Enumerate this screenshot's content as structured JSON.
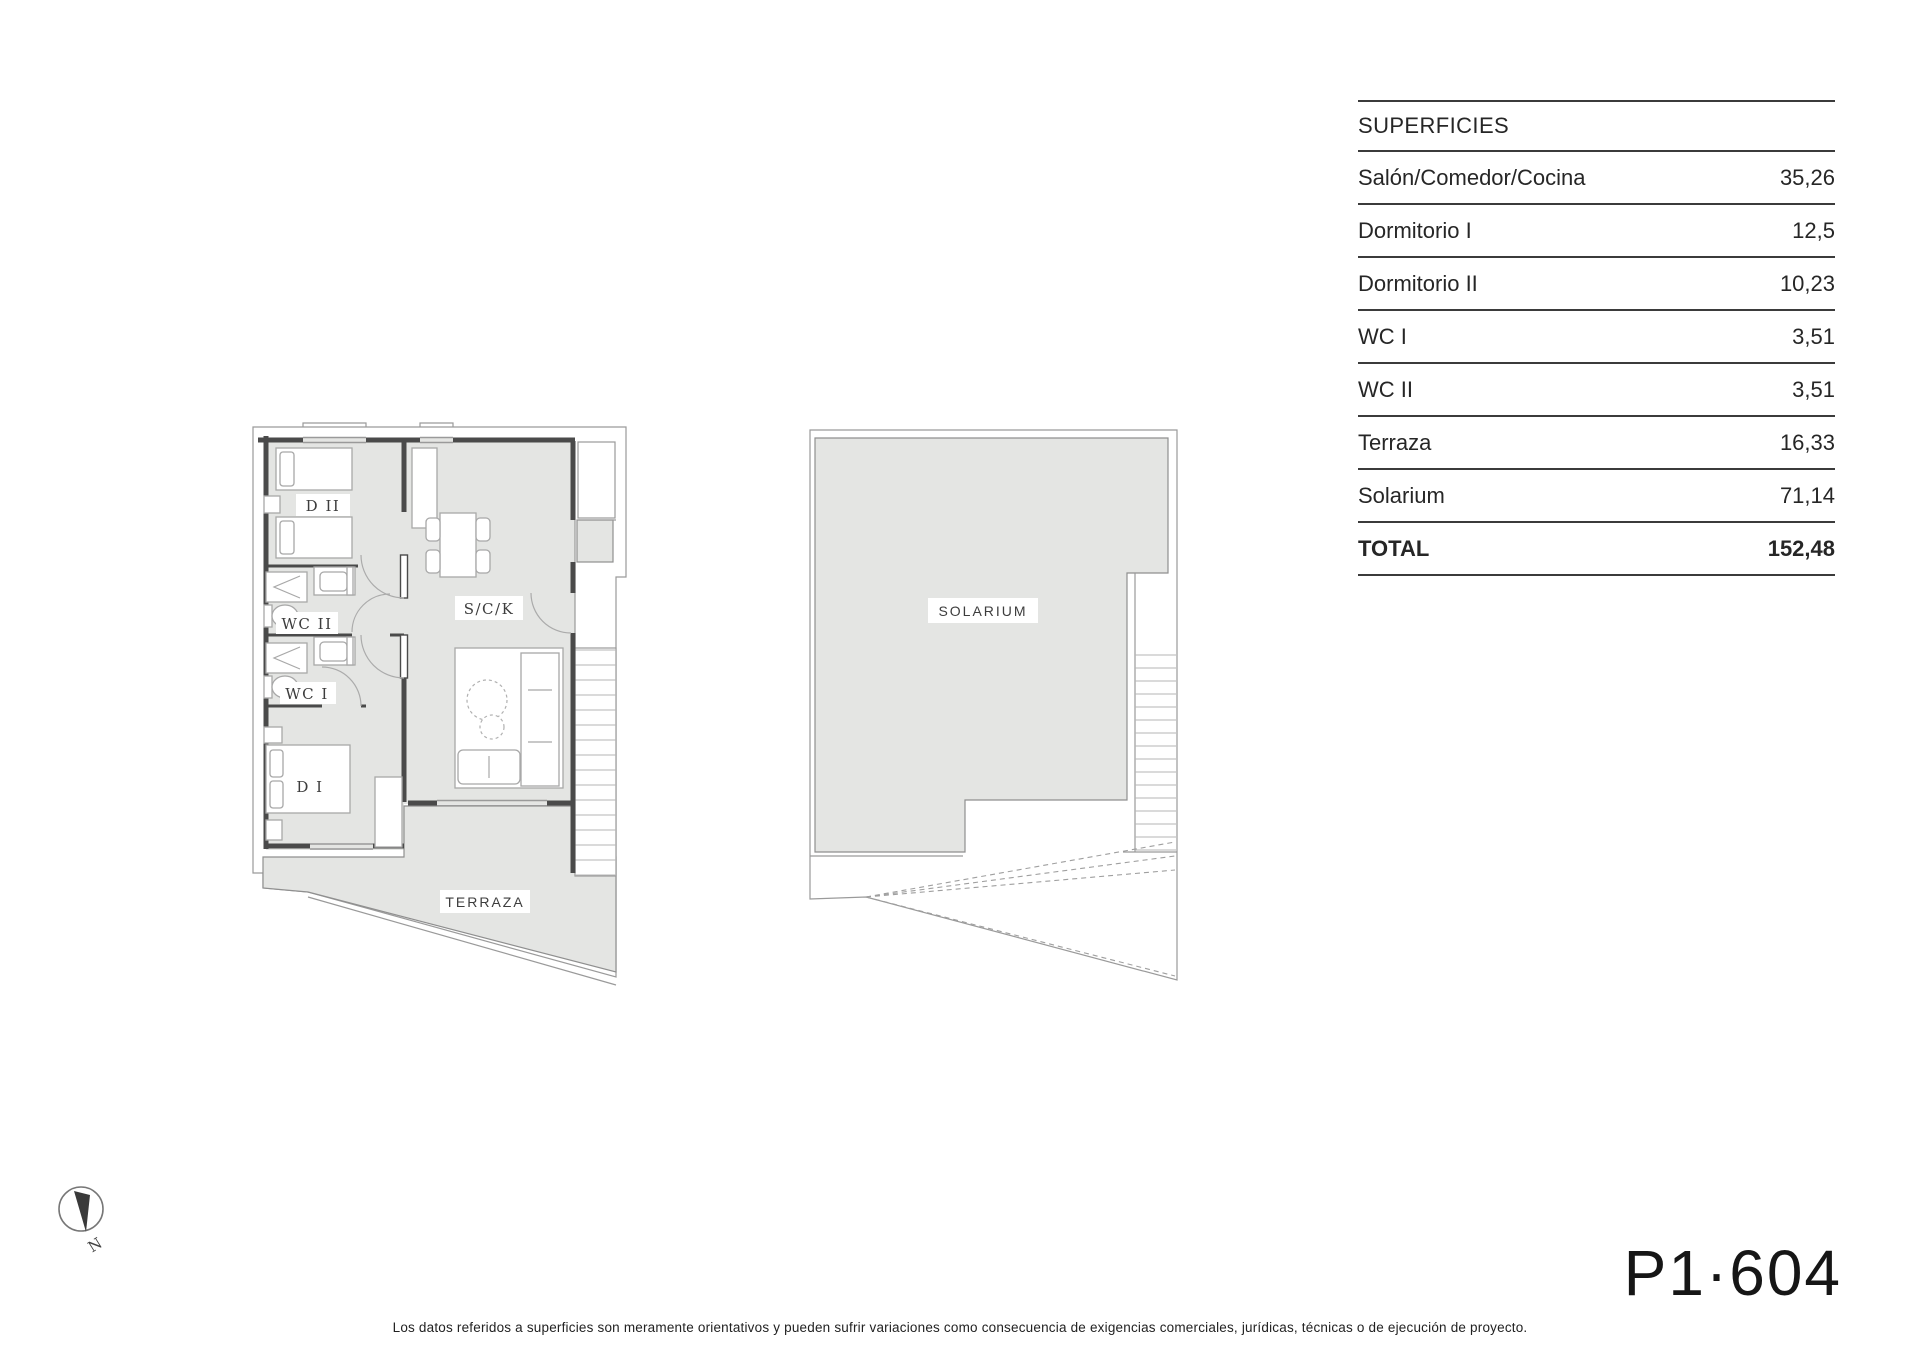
{
  "surfaces_table": {
    "title": "SUPERFICIES",
    "rows": [
      {
        "label": "Salón/Comedor/Cocina",
        "value": "35,26"
      },
      {
        "label": "Dormitorio I",
        "value": "12,5"
      },
      {
        "label": "Dormitorio II",
        "value": "10,23"
      },
      {
        "label": "WC I",
        "value": "3,51"
      },
      {
        "label": "WC II",
        "value": "3,51"
      },
      {
        "label": "Terraza",
        "value": "16,33"
      },
      {
        "label": "Solarium",
        "value": "71,14"
      }
    ],
    "total": {
      "label": "TOTAL",
      "value": "152,48"
    }
  },
  "floor_plan": {
    "labels": {
      "dormitorio_2": "D II",
      "wc_2": "WC II",
      "wc_1": "WC I",
      "dormitorio_1": "D I",
      "salon": "S/C/K",
      "terraza": "TERRAZA"
    }
  },
  "solarium_plan": {
    "label": "SOLARIUM"
  },
  "compass": {
    "north_label": "N"
  },
  "unit_code": "P1·604",
  "disclaimer": "Los datos referidos a superficies son meramente orientativos y pueden sufrir variaciones como consecuencia de exigencias comerciales, jurídicas, técnicas o de ejecución de proyecto.",
  "colors": {
    "floor_fill": "#e4e5e3",
    "wall": "#4a4a4a",
    "thin_line": "#9a9a9a",
    "table_line": "#3b3b3b",
    "text": "#262626"
  }
}
